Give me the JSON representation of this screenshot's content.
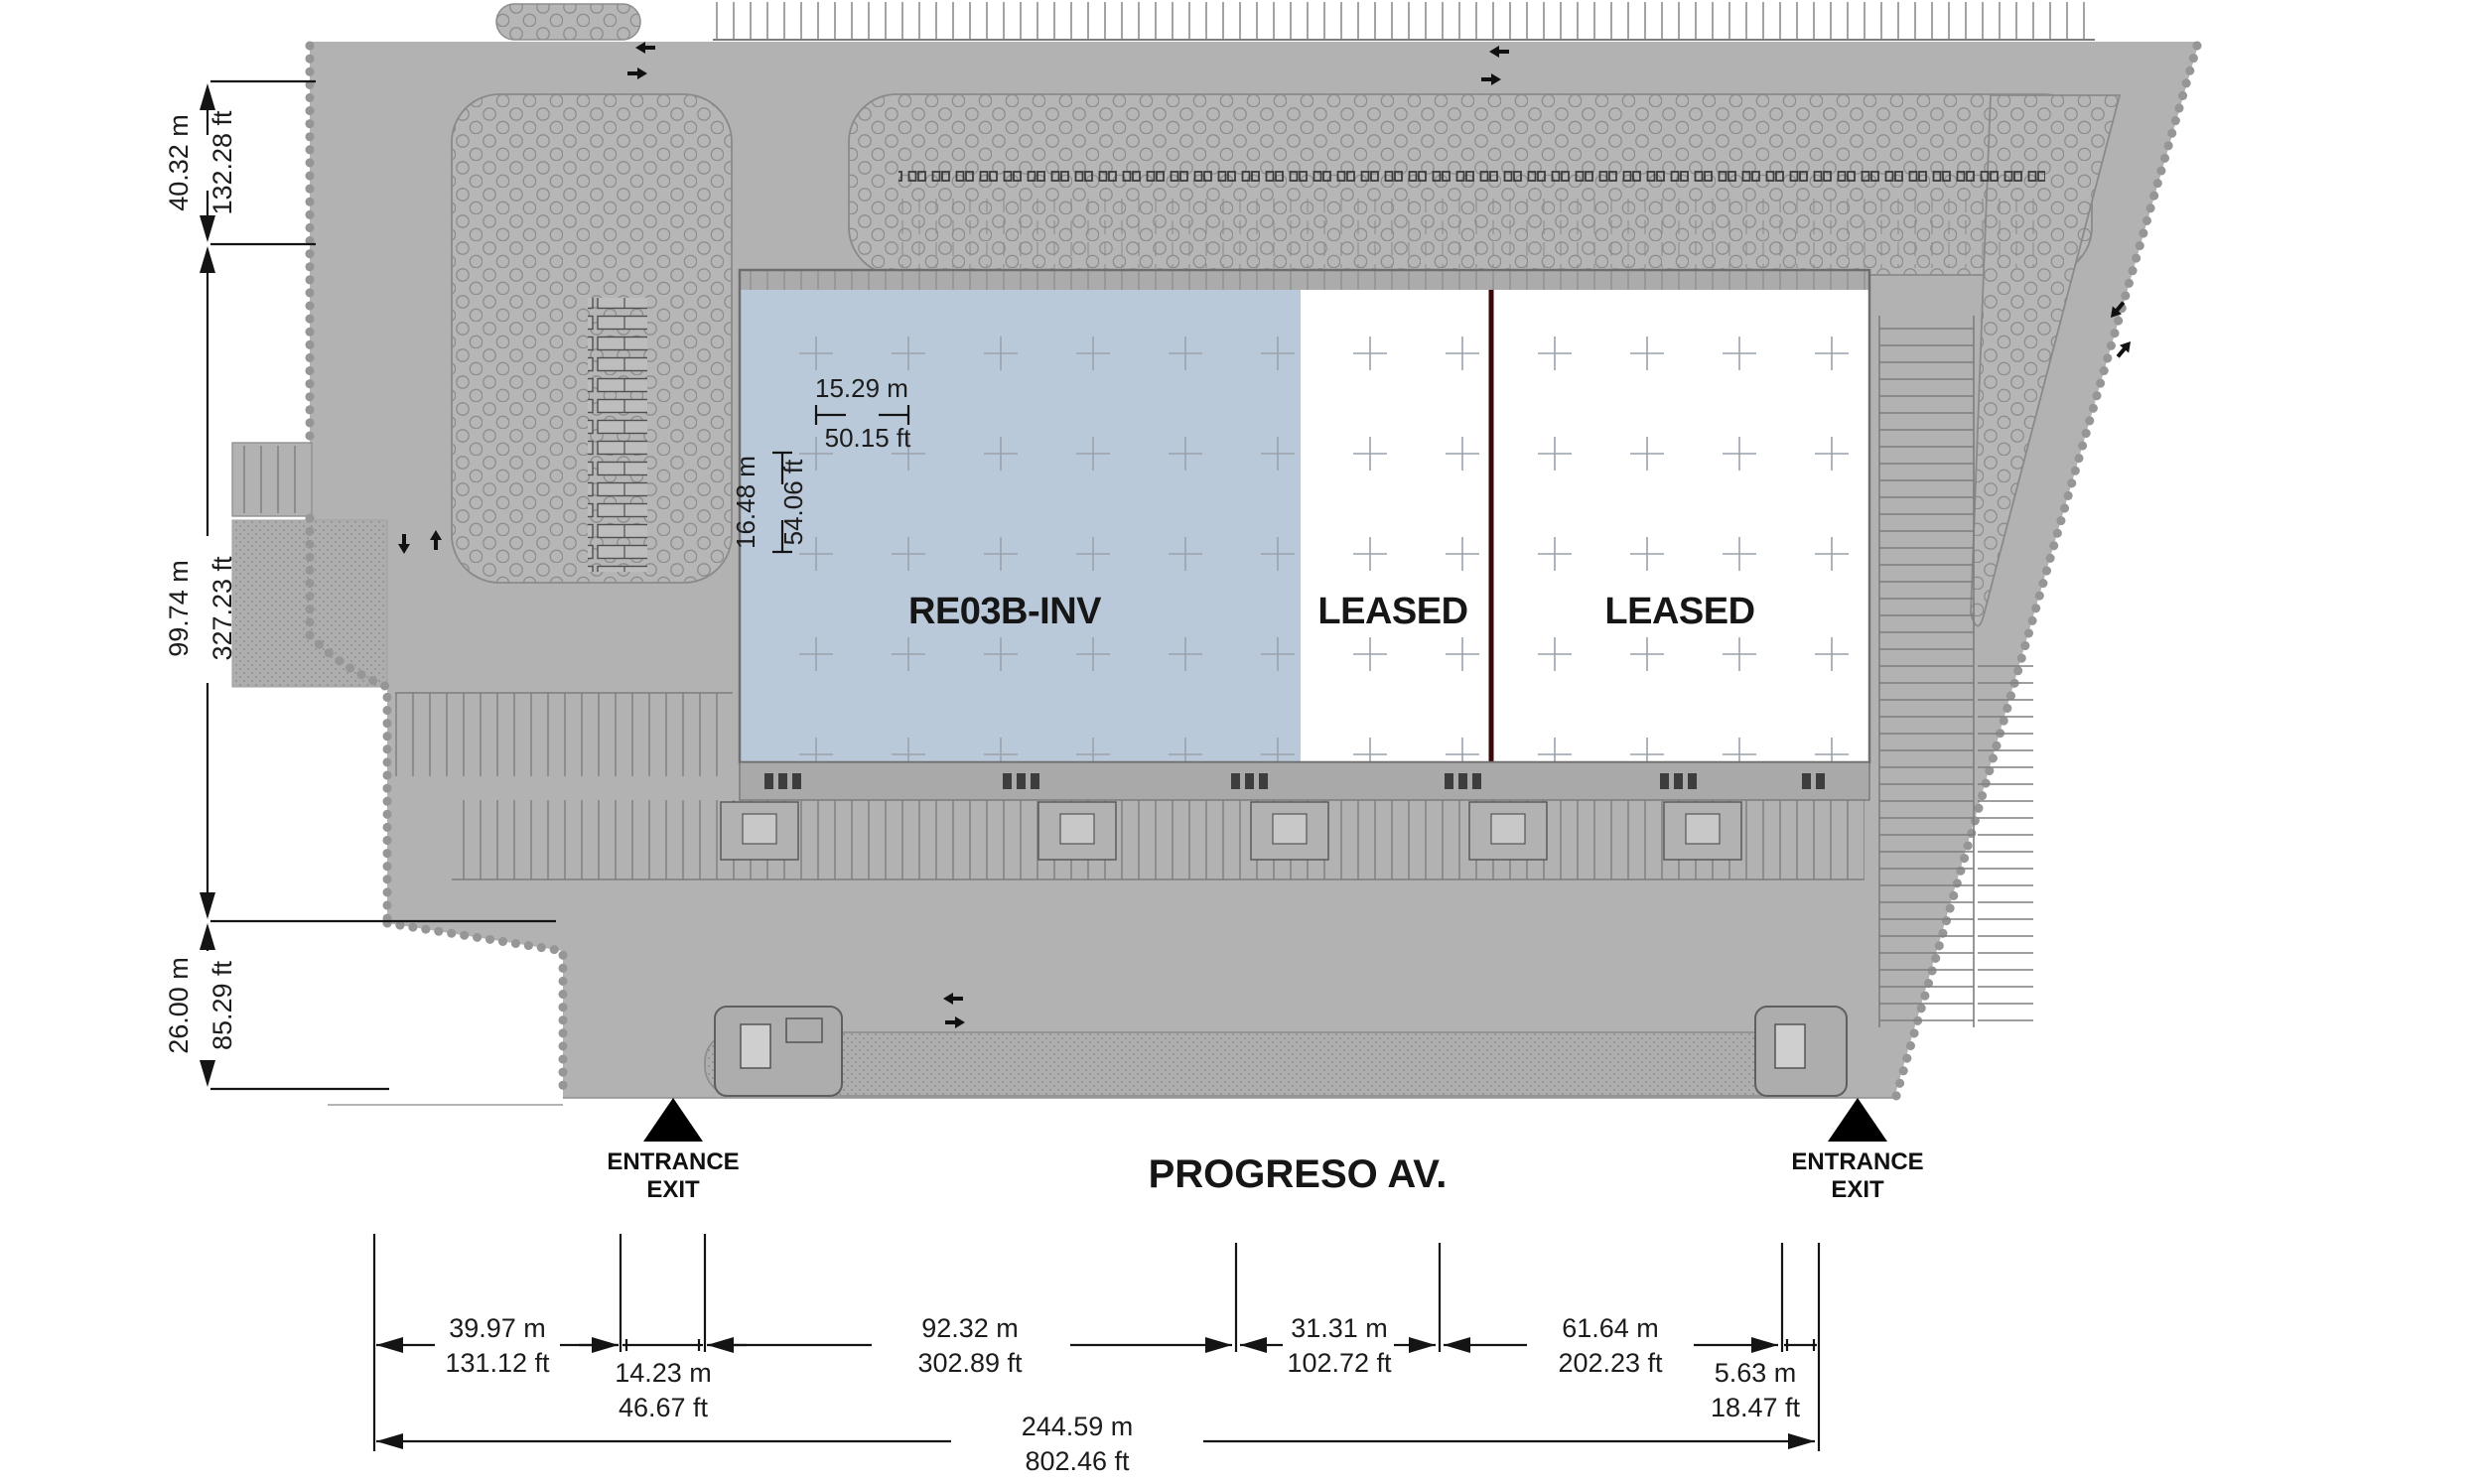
{
  "plan": {
    "title": "Industrial park site plan",
    "building": {
      "units": [
        {
          "label": "RE03B-INV",
          "status": "available"
        },
        {
          "label": "LEASED",
          "status": "leased"
        },
        {
          "label": "LEASED",
          "status": "leased"
        }
      ]
    },
    "street": {
      "name": "PROGRESO AV."
    },
    "entrances": [
      {
        "line1": "ENTRANCE",
        "line2": "EXIT"
      },
      {
        "line1": "ENTRANCE",
        "line2": "EXIT"
      }
    ],
    "dimensions": {
      "left": [
        {
          "metric": "40.32 m",
          "imperial": "132.28 ft"
        },
        {
          "metric": "99.74 m",
          "imperial": "327.23 ft"
        },
        {
          "metric": "26.00 m",
          "imperial": "85.29 ft"
        }
      ],
      "bay": {
        "width": {
          "metric": "15.29 m",
          "imperial": "50.15 ft"
        },
        "depth": {
          "metric": "16.48 m",
          "imperial": "54.06 ft"
        }
      },
      "bottom": [
        {
          "metric": "39.97 m",
          "imperial": "131.12 ft"
        },
        {
          "metric": "14.23 m",
          "imperial": "46.67 ft"
        },
        {
          "metric": "92.32 m",
          "imperial": "302.89 ft"
        },
        {
          "metric": "31.31 m",
          "imperial": "102.72 ft"
        },
        {
          "metric": "61.64 m",
          "imperial": "202.23 ft"
        },
        {
          "metric": "5.63 m",
          "imperial": "18.47 ft"
        }
      ],
      "total": {
        "metric": "244.59 m",
        "imperial": "802.46 ft"
      }
    },
    "colors": {
      "available_fill": "#bac9d9",
      "site_gray": "#b2b2b2",
      "island_gray": "#b6b6b6",
      "divider_maroon": "#3a0708",
      "dimension_ink": "#141414"
    }
  }
}
